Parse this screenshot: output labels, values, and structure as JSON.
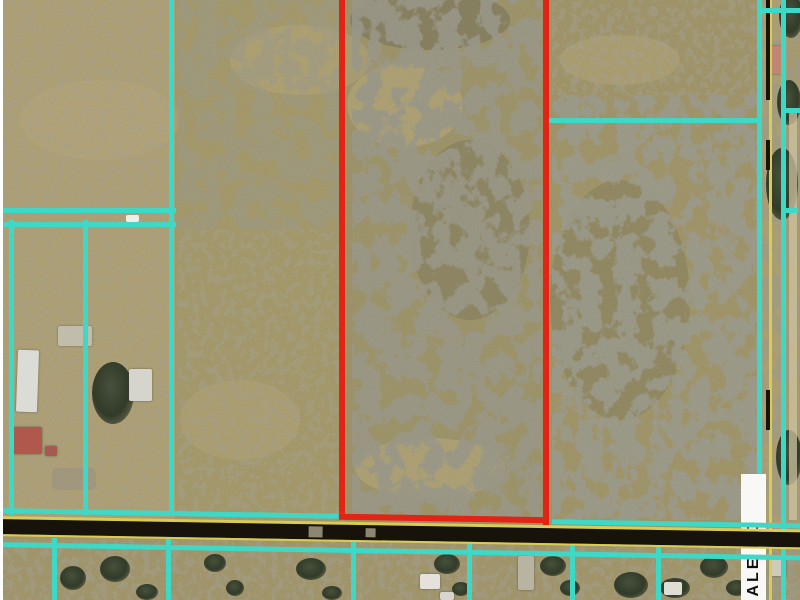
{
  "map": {
    "type": "aerial-parcel-map",
    "road_label": "DALE RD",
    "subject_parcel": {
      "outline_color": "#e32313",
      "shape": "tall-rectangle-center",
      "bottom_boundary": "highway"
    },
    "colors": {
      "parcel_line": "#3ed8c6",
      "subject_outline": "#e32313",
      "road_paint_yellow": "#d9cc52",
      "road_surface": "#18130a",
      "label_bg": "#f8f8f6",
      "label_text": "#101010",
      "terrain_base": "#b2a375"
    },
    "features": {
      "horizontal_road": "two-lane road along bottom edge",
      "vertical_road": "Dale Rd running along right edge",
      "parcel_lines": "cyan boundary overlay",
      "vegetation": "scrub-covered parcels center and east, cleared lots west and south"
    }
  }
}
